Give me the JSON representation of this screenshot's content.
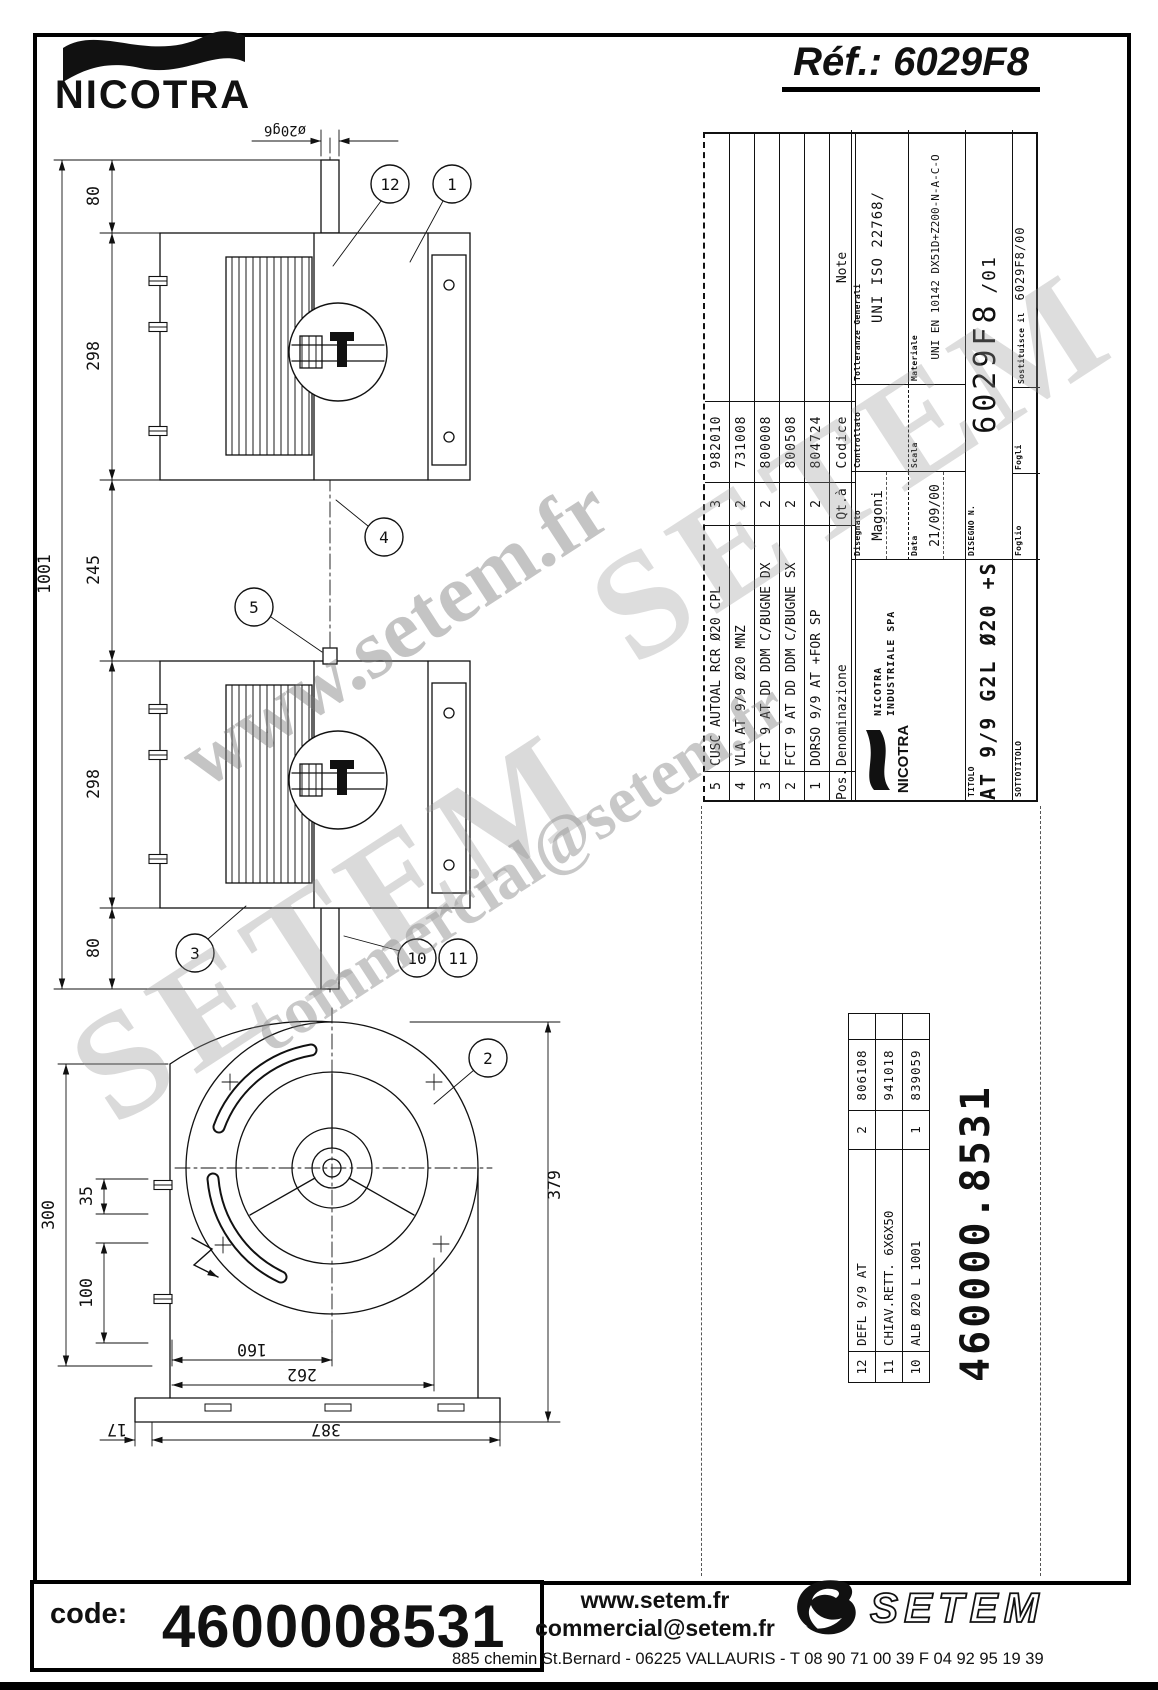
{
  "header": {
    "brand": "NICOTRA",
    "ref": "Réf.: 6029F8"
  },
  "tb": {
    "table": {
      "h": {
        "pos": "Pos.",
        "denom": "Denominazione",
        "qty": "Qt.à",
        "code": "Codice",
        "note": "Note"
      },
      "rows": [
        {
          "pos": "5",
          "denom": "CUSC AUTOAL RCR Ø20 CPL",
          "qty": "3",
          "code": "982010"
        },
        {
          "pos": "4",
          "denom": "VLA AT 9/9 Ø20 MNZ",
          "qty": "2",
          "code": "731008"
        },
        {
          "pos": "3",
          "denom": "FCT 9 AT DD DDM C/BUGNE DX",
          "qty": "2",
          "code": "800008"
        },
        {
          "pos": "2",
          "denom": "FCT 9 AT DD DDM C/BUGNE SX",
          "qty": "2",
          "code": "800508"
        },
        {
          "pos": "1",
          "denom": "DORSO 9/9 AT +FOR SP",
          "qty": "2",
          "code": "804724"
        }
      ]
    },
    "f": {
      "disegnato_l": "Disegnato",
      "disegnato": "Magoni",
      "controllato_l": "Controllato",
      "data_l": "Data",
      "data": "21/09/00",
      "scala_l": "Scala",
      "toll_l": "Tolleranze Generali",
      "toll": "UNI ISO 22768/",
      "mat_l": "Materiale",
      "mat": "UNI EN 10142 DX51D+Z200-N-A-C-O",
      "disegno_l": "DISEGNO N.",
      "disegno": "6029F8",
      "rev": "/01",
      "foglio_l": "Foglio",
      "fogli_l": "Fogli",
      "sost_l": "Sostituisce il",
      "sost": "6029F8/00",
      "titolo_l": "TITOLO",
      "titolo": "AT 9/9 G2L Ø20 +SB",
      "sotto_l": "SOTTOTITOLO"
    },
    "company": {
      "brand": "NICOTRA",
      "line1": "NICOTRA",
      "line2": "INDUSTRIALE SPA"
    }
  },
  "lower": {
    "rows": [
      {
        "pos": "12",
        "denom": "DEFL 9/9 AT",
        "qty": "2",
        "code": "806108"
      },
      {
        "pos": "11",
        "denom": "CHIAV.RETT. 6X6X50",
        "qty": "1",
        "code": "941018"
      },
      {
        "pos": "10",
        "denom": "ALB Ø20 L 1001",
        "qty": "1",
        "code": "839059"
      }
    ]
  },
  "big_code": "460000.8531",
  "dwg": {
    "side": {
      "dia": "ø20g6",
      "d80a": "80",
      "d298a": "298",
      "d245": "245",
      "d298b": "298",
      "d80b": "80",
      "d1001": "1001",
      "b12": "12",
      "b1": "1",
      "b4": "4",
      "b5": "5",
      "b3": "3",
      "b10": "10",
      "b11": "11"
    },
    "front": {
      "d300": "300",
      "d35": "35",
      "d100": "100",
      "d379": "379",
      "d160": "160",
      "d262": "262",
      "d387": "387",
      "d17": "17",
      "b2": "2"
    }
  },
  "wm": {
    "w1": "www.setem.fr",
    "w2": "commercial@setem.fr",
    "w3": "SETEM",
    "w4": "SETEM"
  },
  "footer": {
    "code_l": "code:",
    "code": "4600008531",
    "web": "www.setem.fr",
    "email": "commercial@setem.fr",
    "address": "885 chemin St.Bernard  -  06225 VALLAURIS  -  T 08 90 71 00 39   F 04 92 95 19 39",
    "logo": "SETEM"
  }
}
